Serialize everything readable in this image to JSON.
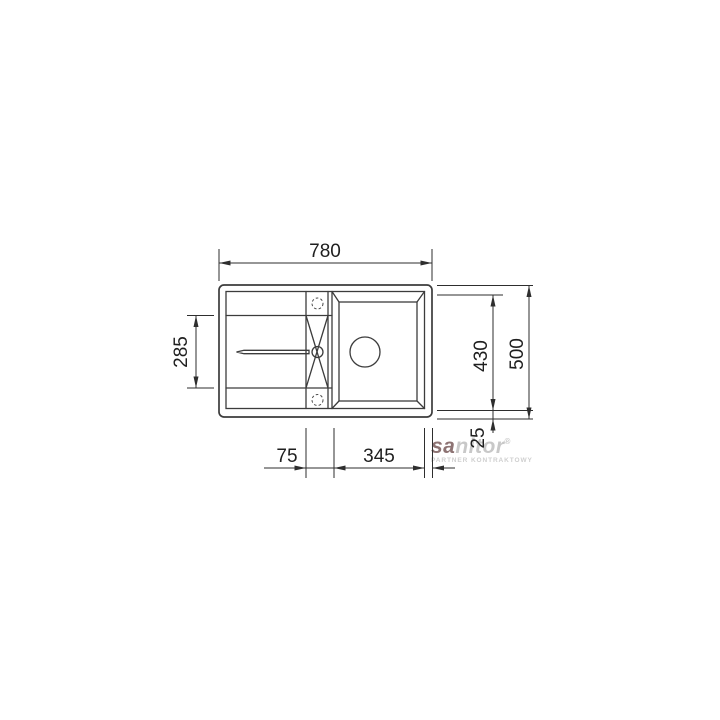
{
  "diagram": {
    "dimension_labels": {
      "top_width": "780",
      "left_depth": "285",
      "right_inner_depth": "430",
      "right_total_depth": "500",
      "bottom_ledge": "75",
      "bottom_bowl": "345",
      "bottom_offset": "25"
    },
    "colors": {
      "line": "#3c3c3c",
      "dimension_text": "#1f1f1f"
    }
  },
  "watermark": {
    "logo_prefix": "sa",
    "logo_suffix": "nitor",
    "registered": "®",
    "subtitle": "PARTNER KONTRAKTOWY",
    "color_light": "#c8c8c8",
    "color_dark": "#8d7373"
  }
}
